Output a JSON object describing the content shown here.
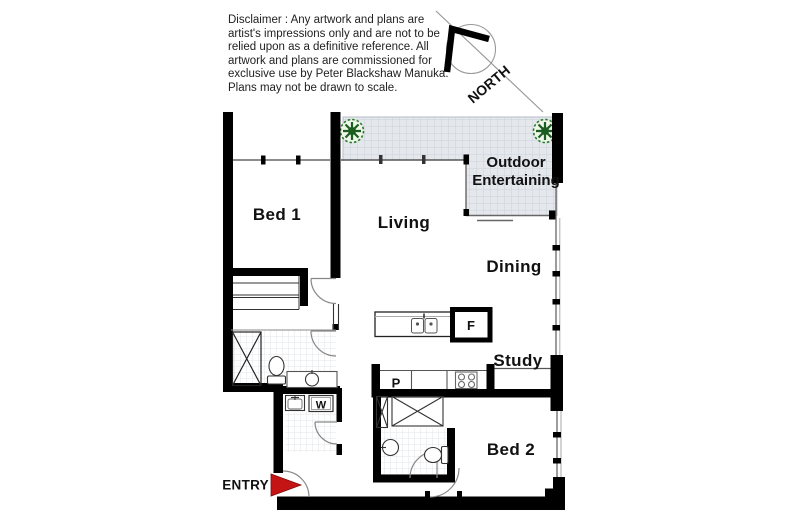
{
  "disclaimer": {
    "lines": [
      "Disclaimer : Any artwork and plans are",
      "artist's impressions only and are not to be",
      "relied upon as a definitive reference. All",
      "artwork and plans are commissioned for",
      "exclusive use by Peter Blackshaw Manuka.",
      "Plans may not be drawn to scale."
    ]
  },
  "compass": {
    "label": "NORTH"
  },
  "rooms": {
    "bed1": "Bed 1",
    "living": "Living",
    "outdoor_line1": "Outdoor",
    "outdoor_line2": "Entertaining",
    "dining": "Dining",
    "study": "Study",
    "bed2": "Bed 2"
  },
  "fixtures": {
    "fridge": "F",
    "pantry": "P",
    "washer": "W"
  },
  "entry": {
    "label": "ENTRY"
  },
  "icons": [
    "north-compass-icon",
    "plant-icon",
    "entry-arrow-icon",
    "shower-icon",
    "toilet-icon",
    "basin-icon",
    "kitchen-sink-icon",
    "cooktop-icon",
    "washer-icon",
    "laundry-tub-icon",
    "robe-icon",
    "door-arc"
  ],
  "colors": {
    "wall": "#000000",
    "tile_fill": "#e4e7ec",
    "tile_line": "#cdd3db",
    "plant_green": "#1e7a1e",
    "entry_arrow_red": "#c51414",
    "text": "#111111"
  }
}
